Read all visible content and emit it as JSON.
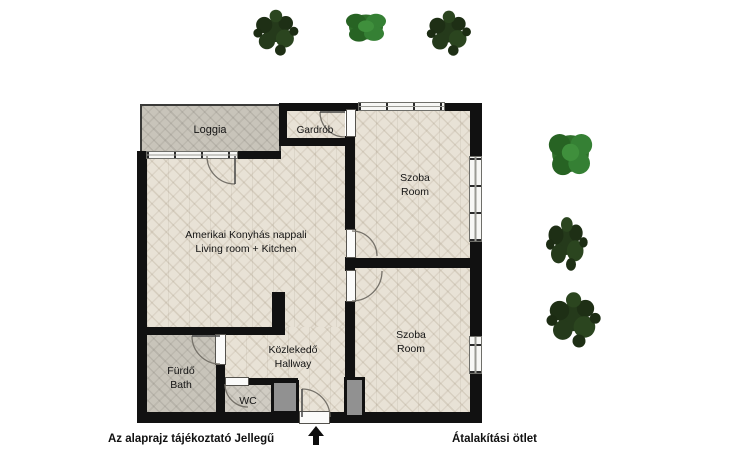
{
  "plan": {
    "rooms": {
      "loggia": {
        "label": "Loggia"
      },
      "gardrob": {
        "label": "Gardrób"
      },
      "room_top": {
        "name_hu": "Szoba",
        "name_en": "Room"
      },
      "living_room": {
        "name_hu": "Amerikai Konyhás nappali",
        "name_en": "Living room + Kitchen"
      },
      "room_bottom": {
        "name_hu": "Szoba",
        "name_en": "Room"
      },
      "hallway": {
        "name_hu": "Közlekedő",
        "name_en": "Hallway"
      },
      "bathroom": {
        "name_hu": "Fürdő",
        "name_en": "Bath"
      },
      "wc": {
        "label": "WC"
      }
    },
    "colors": {
      "wall": "#111111",
      "wood_floor": "#e8e2d6",
      "grey_floor": "#c8c4ba",
      "shaft": "#919191",
      "tree_dark": "#24391b",
      "tree_light": "#2f6f2a"
    },
    "icons": {
      "entry_arrow": "up-arrow-icon",
      "trees": [
        "tree-icon",
        "tree-icon",
        "tree-icon",
        "tree-icon",
        "tree-icon",
        "tree-icon"
      ]
    }
  },
  "footer": {
    "left_note": "Az alaprajz tájékoztató Jellegű",
    "right_note": "Átalakítási ötlet"
  }
}
